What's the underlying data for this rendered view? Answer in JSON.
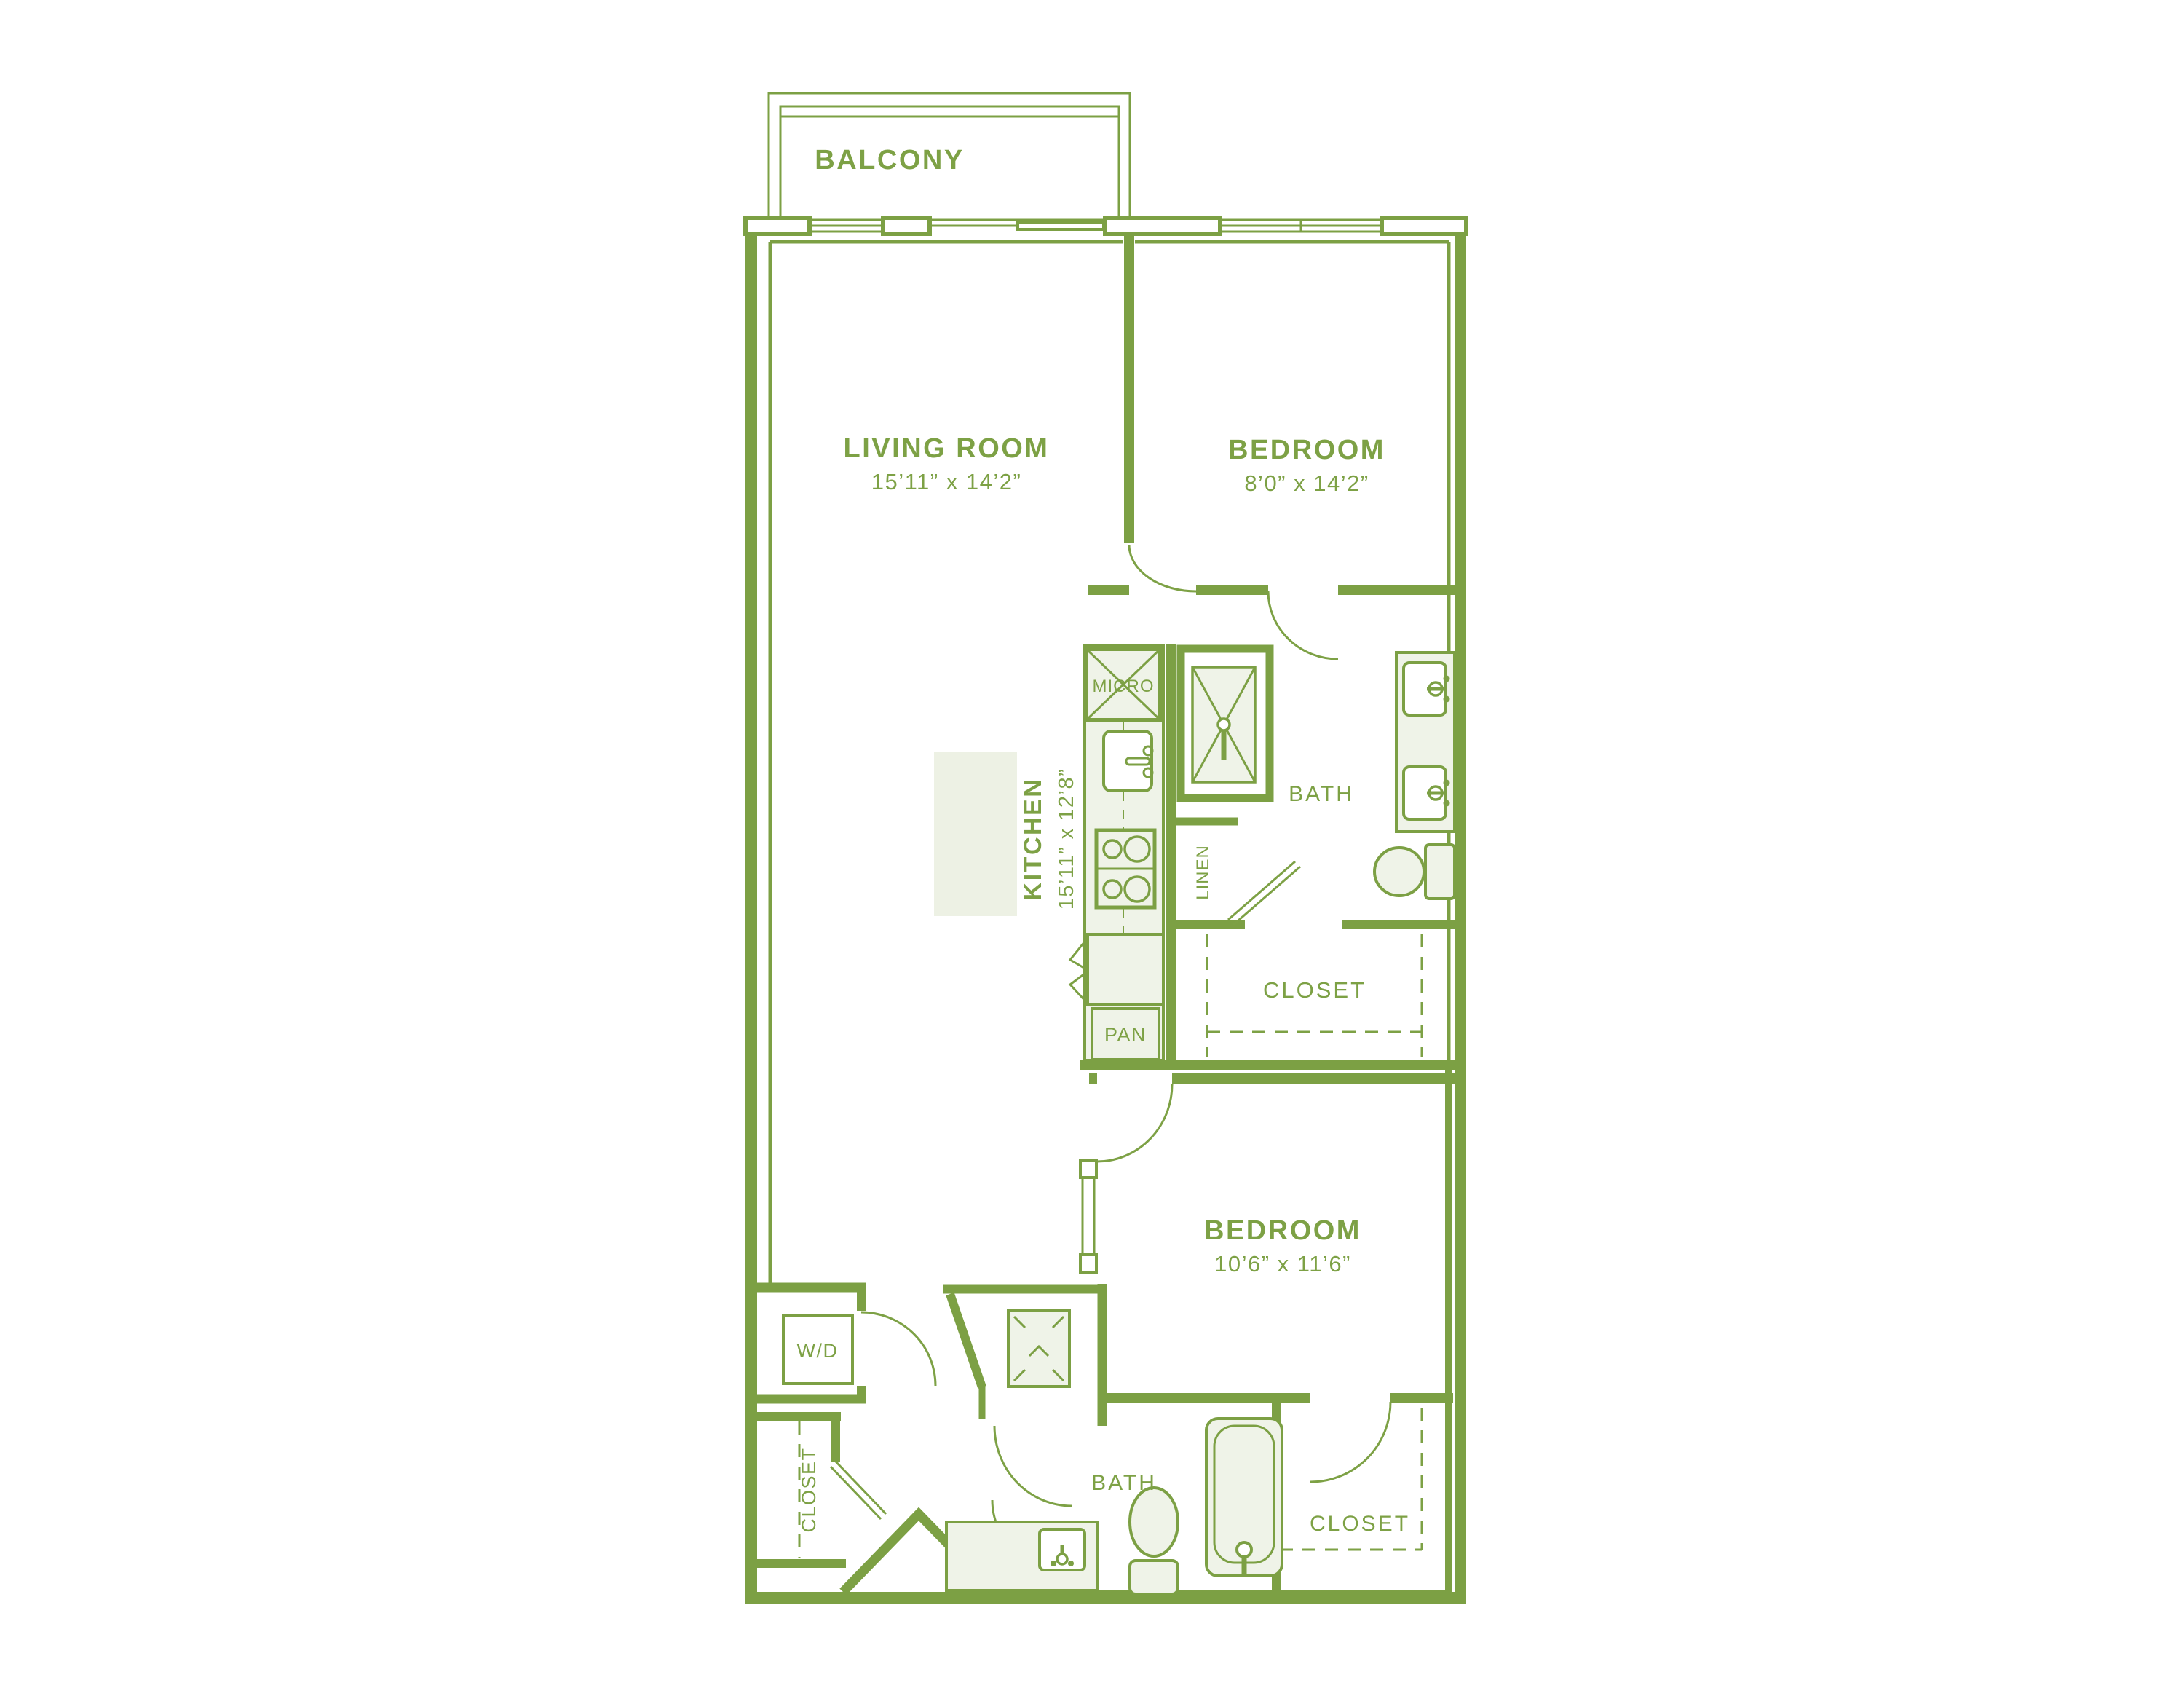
{
  "plan": {
    "balcony": {
      "label": "BALCONY"
    },
    "living_room": {
      "label": "LIVING ROOM",
      "dims": "15’11” x 14’2”"
    },
    "bedroom_top": {
      "label": "BEDROOM",
      "dims": "8’0” x 14’2”"
    },
    "bedroom_bottom": {
      "label": "BEDROOM",
      "dims": "10’6” x 11’6”"
    },
    "kitchen": {
      "label": "KITCHEN",
      "dims": "15’11” x 12’8”"
    },
    "bath_top": {
      "label": "BATH"
    },
    "bath_bottom": {
      "label": "BATH"
    },
    "closet_top": {
      "label": "CLOSET"
    },
    "closet_bottom_right": {
      "label": "CLOSET"
    },
    "closet_entry": {
      "label": "CLOSET"
    },
    "linen": {
      "label": "LINEN"
    },
    "micro": {
      "label": "MICRO"
    },
    "pantry": {
      "label": "PAN"
    },
    "washer_dryer": {
      "label": "W/D"
    },
    "colors": {
      "wall": "#7CA044",
      "fixture_fill": "#EFF3E8",
      "island_fill": "#EDF1E4"
    }
  }
}
